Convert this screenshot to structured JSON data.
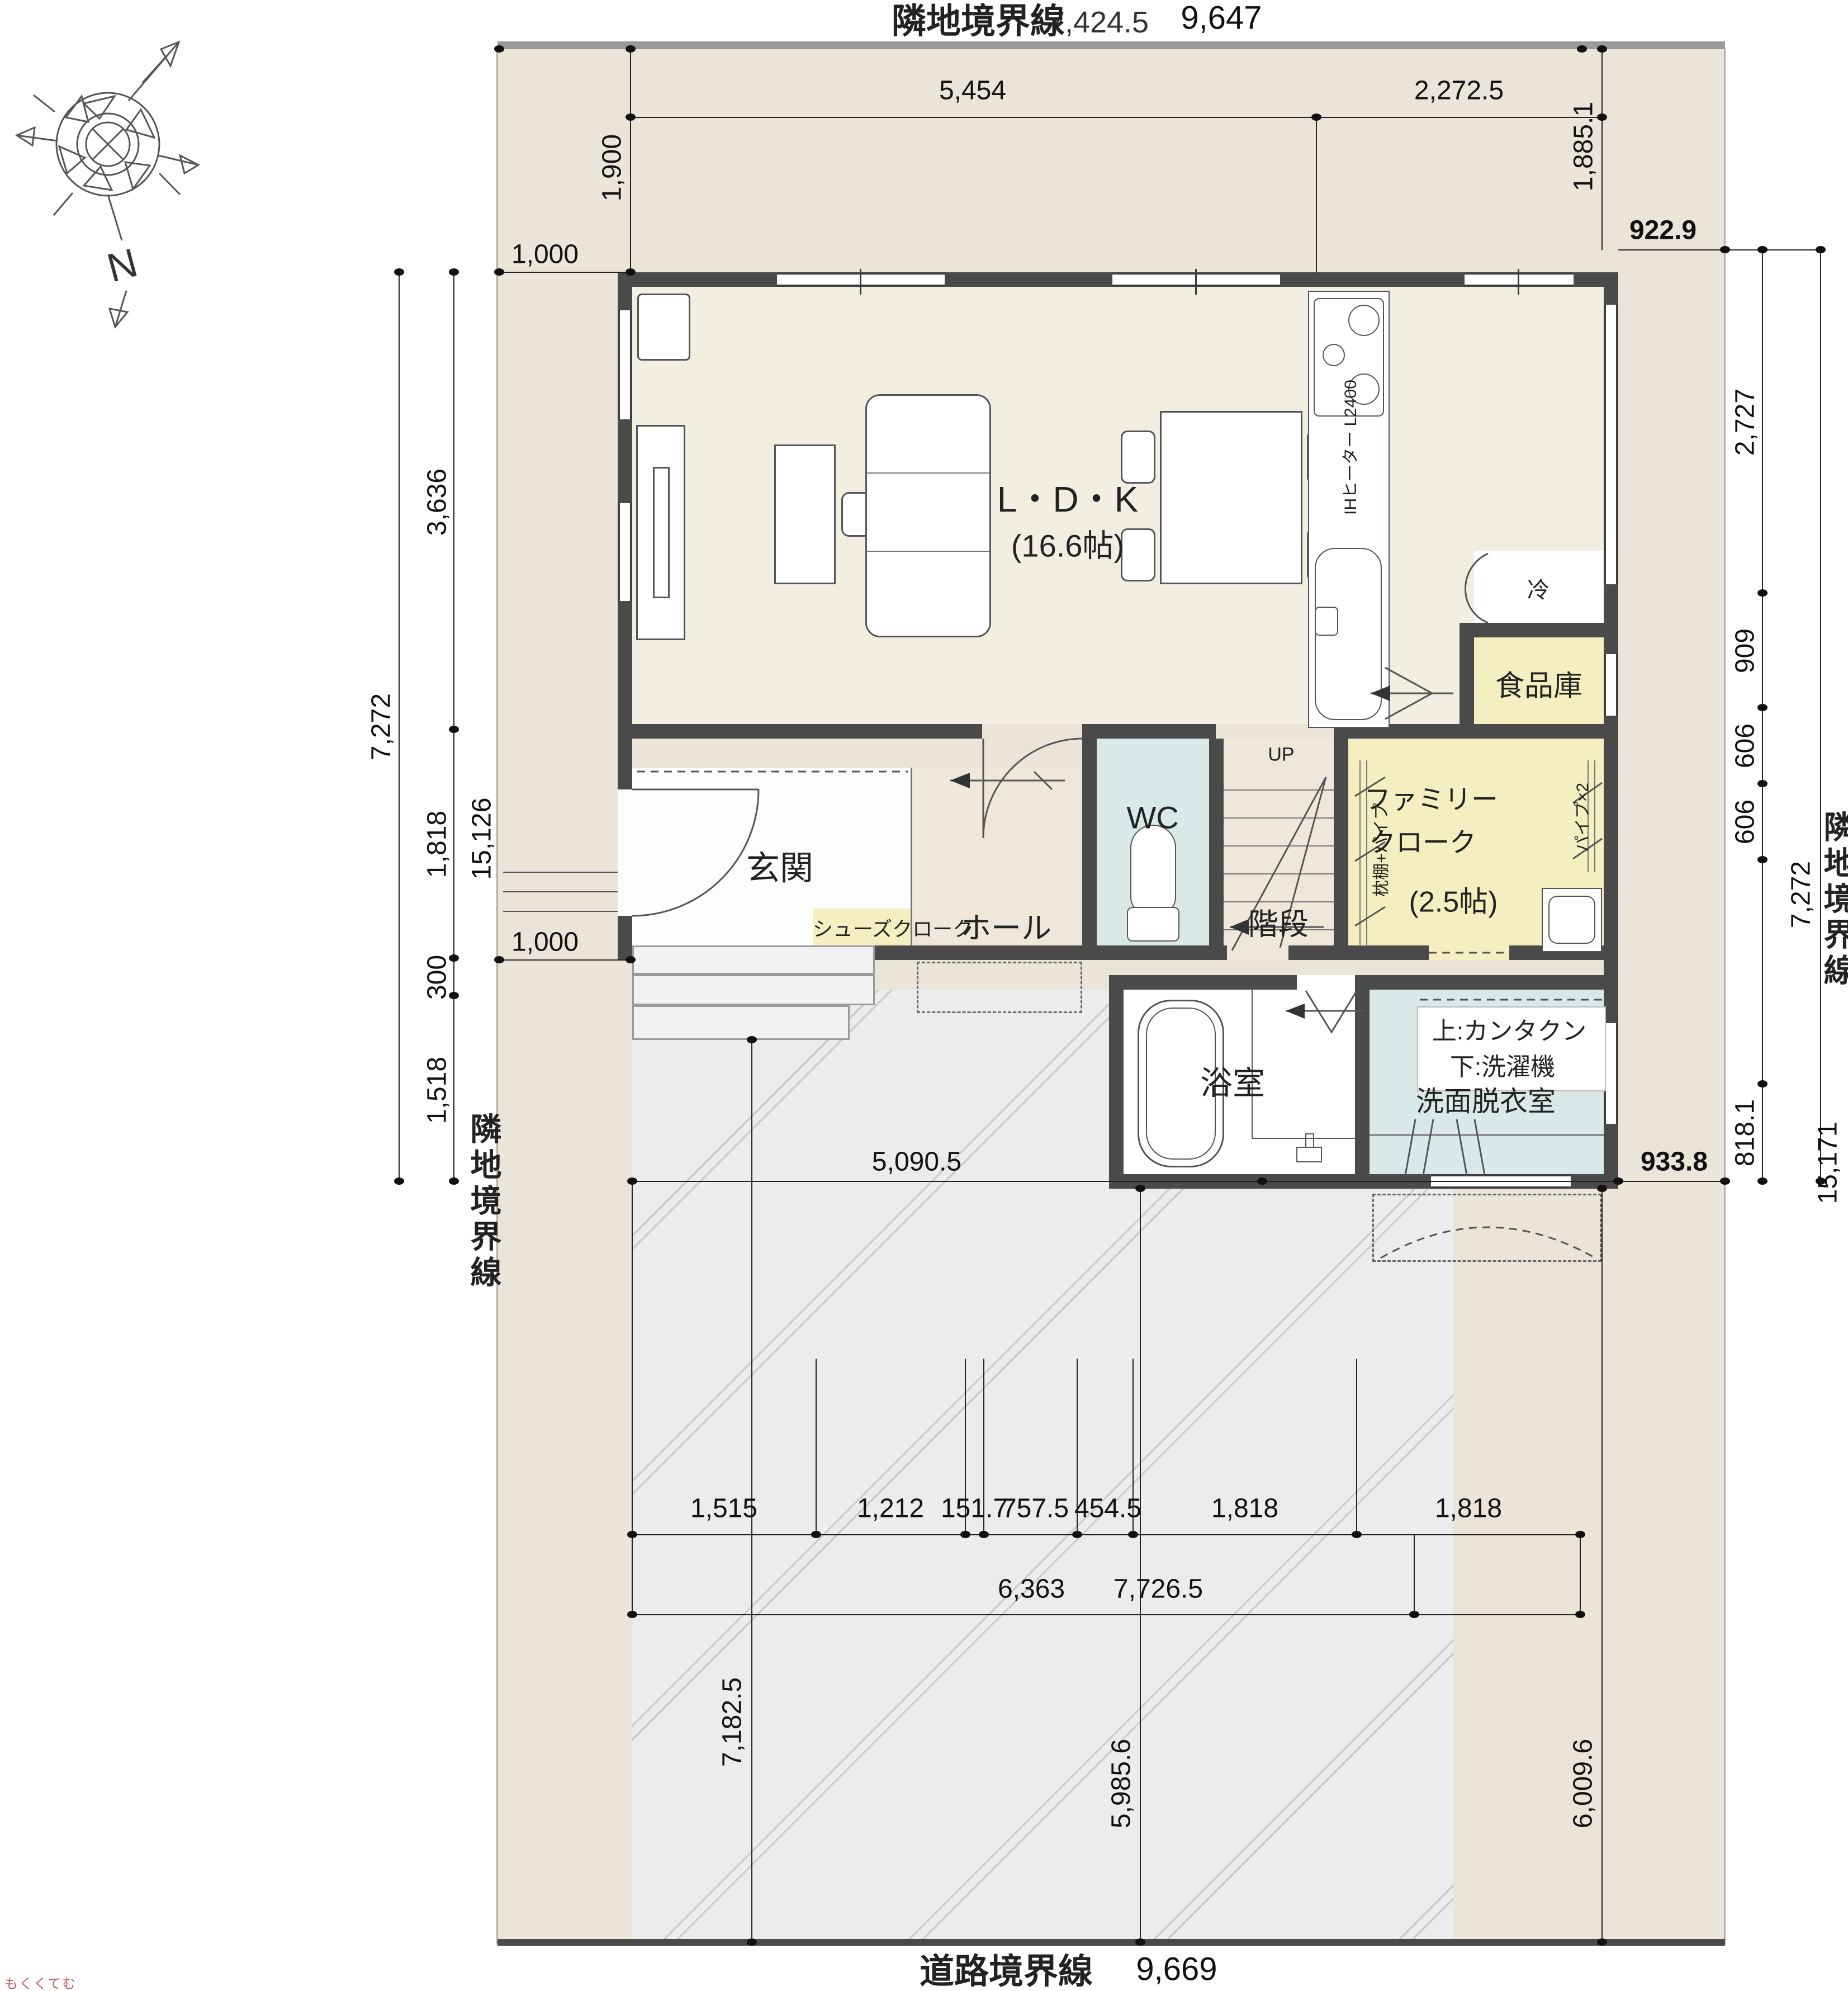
{
  "compass": {
    "north_label": "N"
  },
  "boundaries": {
    "top_label": "隣地境界線",
    "top_total": "9,647",
    "top_overlap": "7,424.5",
    "left_label": "隣地境界線",
    "left_total": "15,126",
    "right_label": "隣地境界線",
    "right_total": "15,171",
    "road_label": "道路境界線",
    "road_total": "9,669"
  },
  "rooms": {
    "ldk_name": "L・D・K",
    "ldk_size": "(16.6帖)",
    "genkan": "玄関",
    "hall": "ホール",
    "wc": "WC",
    "stairs": "階段",
    "stairs_up": "UP",
    "family_l1": "ファミリー",
    "family_l2": "クローク",
    "family_size": "(2.5帖)",
    "pantry": "食品庫",
    "shoes": "シューズクローク",
    "bath": "浴室",
    "wash_name": "洗面脱衣室",
    "wash_note1": "上:カンタクン",
    "wash_note2": "下:洗濯機"
  },
  "fixtures": {
    "ih": "IHヒーター L2400",
    "fridge": "冷",
    "closet_left": "枕棚+パイプ",
    "closet_right": "パイプ×2"
  },
  "dims": {
    "v1900": "1,900",
    "h1000a": "1,000",
    "h1000b": "1,000",
    "v1885": "1,885.1",
    "top1": "5,454",
    "top2": "2,272.5",
    "left_inner": [
      "3,636",
      "1,818",
      "300",
      "1,518"
    ],
    "left_outer": "7,272",
    "right_top": "922.9",
    "right_inner": [
      "2,727",
      "909",
      "606",
      "606",
      "818.1"
    ],
    "right_outer": "7,272",
    "right_bottom": "933.8",
    "width_mid": "5,090.5",
    "row1": [
      "1,515",
      "1,212",
      "151.7",
      "757.5",
      "454.5",
      "1,818",
      "1,818"
    ],
    "row2": [
      "6,363",
      "7,726.5"
    ],
    "park": [
      "7,182.5",
      "5,985.6",
      "6,009.6"
    ]
  },
  "watermark": "もくくてむ"
}
